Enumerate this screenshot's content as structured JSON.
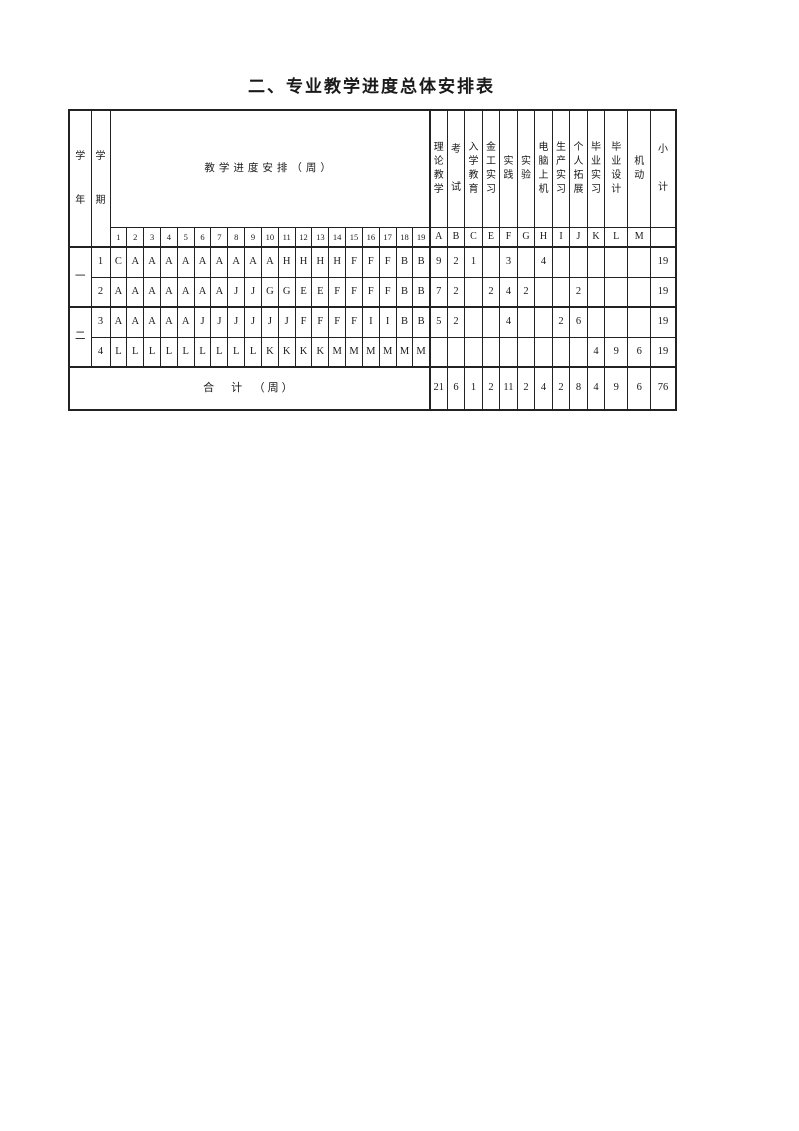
{
  "page": {
    "title": "二、专业教学进度总体安排表"
  },
  "table": {
    "corner": {
      "year_header": "学年",
      "semester_header": "学期"
    },
    "weeks_header": "教学进度安排（周）",
    "week_numbers": [
      "1",
      "2",
      "3",
      "4",
      "5",
      "6",
      "7",
      "8",
      "9",
      "10",
      "11",
      "12",
      "13",
      "14",
      "15",
      "16",
      "17",
      "18",
      "19"
    ],
    "categories": [
      {
        "code": "A",
        "label": "理论教学",
        "spread": false
      },
      {
        "code": "B",
        "label": "考试",
        "spread": true
      },
      {
        "code": "C",
        "label": "入学教育",
        "spread": false
      },
      {
        "code": "E",
        "label": "金工实习",
        "spread": false
      },
      {
        "code": "F",
        "label": "实践",
        "spread": false
      },
      {
        "code": "G",
        "label": "实验",
        "spread": false
      },
      {
        "code": "H",
        "label": "电脑上机",
        "spread": false
      },
      {
        "code": "I",
        "label": "生产实习",
        "spread": false
      },
      {
        "code": "J",
        "label": "个人拓展",
        "spread": false
      },
      {
        "code": "K",
        "label": "毕业实习",
        "spread": false
      },
      {
        "code": "L",
        "label": "毕业设计",
        "spread": false
      },
      {
        "code": "M",
        "label": "机动",
        "spread": false
      }
    ],
    "subtotal_header": {
      "label": "小计",
      "spread": true
    },
    "years": [
      {
        "label": "一",
        "semesters": [
          {
            "number": "1",
            "weeks": [
              "C",
              "A",
              "A",
              "A",
              "A",
              "A",
              "A",
              "A",
              "A",
              "A",
              "H",
              "H",
              "H",
              "H",
              "F",
              "F",
              "F",
              "B",
              "B"
            ],
            "category_totals": [
              "9",
              "2",
              "1",
              "",
              "3",
              "",
              "4",
              "",
              "",
              "",
              "",
              ""
            ],
            "subtotal": "19"
          },
          {
            "number": "2",
            "weeks": [
              "A",
              "A",
              "A",
              "A",
              "A",
              "A",
              "A",
              "J",
              "J",
              "G",
              "G",
              "E",
              "E",
              "F",
              "F",
              "F",
              "F",
              "B",
              "B"
            ],
            "category_totals": [
              "7",
              "2",
              "",
              "2",
              "4",
              "2",
              "",
              "",
              "2",
              "",
              "",
              ""
            ],
            "subtotal": "19"
          }
        ]
      },
      {
        "label": "二",
        "semesters": [
          {
            "number": "3",
            "weeks": [
              "A",
              "A",
              "A",
              "A",
              "A",
              "J",
              "J",
              "J",
              "J",
              "J",
              "J",
              "F",
              "F",
              "F",
              "F",
              "I",
              "I",
              "B",
              "B"
            ],
            "category_totals": [
              "5",
              "2",
              "",
              "",
              "4",
              "",
              "",
              "2",
              "6",
              "",
              "",
              ""
            ],
            "subtotal": "19"
          },
          {
            "number": "4",
            "weeks": [
              "L",
              "L",
              "L",
              "L",
              "L",
              "L",
              "L",
              "L",
              "L",
              "K",
              "K",
              "K",
              "K",
              "M",
              "M",
              "M",
              "M",
              "M",
              "M"
            ],
            "category_totals": [
              "",
              "",
              "",
              "",
              "",
              "",
              "",
              "",
              "",
              "4",
              "9",
              "6"
            ],
            "subtotal": "19"
          }
        ]
      }
    ],
    "grand_total": {
      "label": "合　计　（周）",
      "category_totals": [
        "21",
        "6",
        "1",
        "2",
        "11",
        "2",
        "4",
        "2",
        "8",
        "4",
        "9",
        "6"
      ],
      "subtotal": "76"
    }
  }
}
